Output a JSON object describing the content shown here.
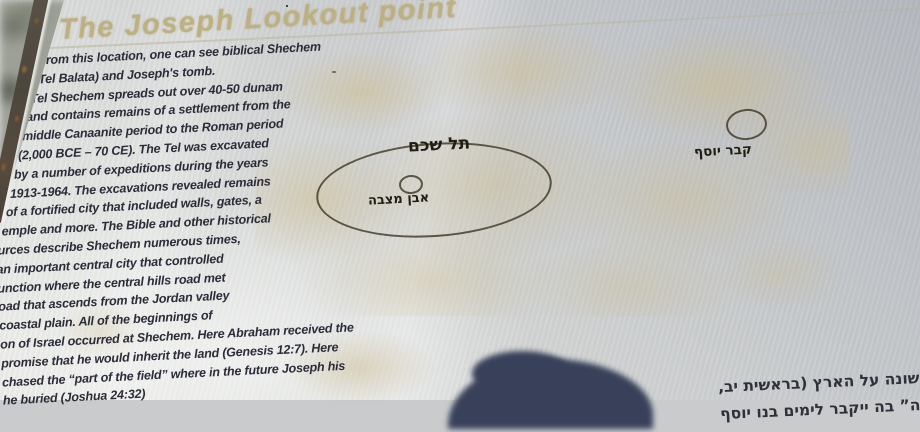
{
  "sign": {
    "title": "The Joseph Lookout point",
    "english_text": {
      "lines": [
        "From this location, one can see biblical Shechem",
        "(Tel Balata) and Joseph's tomb.",
        "Tel Shechem spreads out over 40-50 dunam",
        "and contains remains of a settlement from the",
        "middle Canaanite period to the Roman period",
        "(2,000 BCE – 70 CE). The Tel was excavated",
        "by a number of expeditions during the years",
        "1913-1964. The excavations revealed remains",
        "of a fortified city that included walls, gates, a",
        "emple and more. The Bible and other historical",
        "urces describe Shechem numerous times,",
        "an important central city that controlled",
        "unction where the central hills road met",
        "oad that ascends from the Jordan valley",
        "coastal plain. All of the beginnings of",
        "on of Israel occurred at Shechem. Here Abraham received the",
        "promise that he would inherit the land (Genesis 12:7). Here",
        "chased the “part of the field” where in the future Joseph his",
        "he buried (Joshua 24:32)"
      ]
    },
    "hebrew_text": {
      "lines": [
        "השקיף על שכם",
        "יף. תל שכם",
        "שרידי יישוב",
        "יד לתקופה",
        "נ). בתל נער",
        "על ידי מספר",
        "יר מבוצרת",
        "ד. שכם",
        "היסטוריים",
        "צומת",
        "ת הדרך",
        "החוף. כל",
        "כם. כאן",
        "הראשונה על הארץ (בראשית יב,",
        "השדה” בה ייקבר לימים בנו יוסף"
      ]
    },
    "map": {
      "labels": {
        "tel_shechem": "תל שכם",
        "matzeva": "אבן מצבה",
        "josephs_tomb": "קבר יוסף"
      }
    },
    "colors": {
      "sign_metal": "#c9cbcc",
      "title_gold": "#beb07e",
      "text_dark": "#2c2c38",
      "aerial_tan": "#cebd90",
      "shadow_navy": "#39415a",
      "rust": "#8a5a2e"
    }
  }
}
